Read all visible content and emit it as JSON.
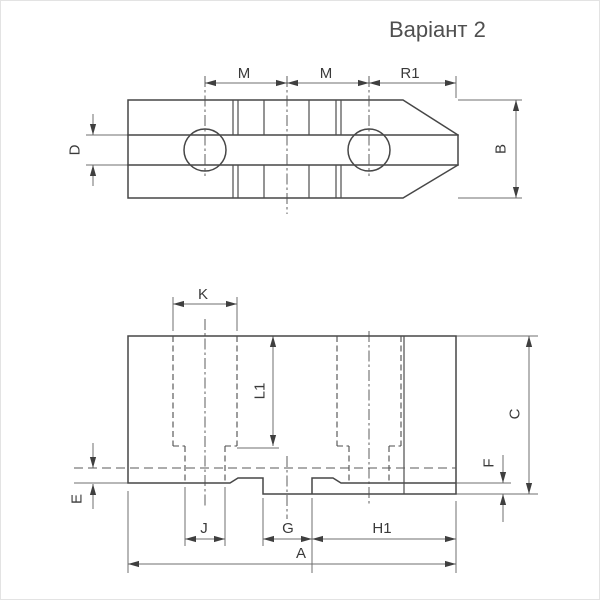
{
  "title": "Варіант 2",
  "top_view": {
    "labels": {
      "m1": "M",
      "m2": "M",
      "r1": "R1",
      "d": "D",
      "b": "B"
    }
  },
  "bottom_view": {
    "labels": {
      "k": "K",
      "l1": "L1",
      "c": "C",
      "f": "F",
      "e": "E",
      "j": "J",
      "g": "G",
      "h1": "H1",
      "a": "A"
    }
  },
  "colors": {
    "outline": "#474747",
    "dimension_lines": "#6f6f6f",
    "label_text": "#3a3a3a",
    "title_text": "#4f4f4f",
    "background": "#ffffff"
  }
}
